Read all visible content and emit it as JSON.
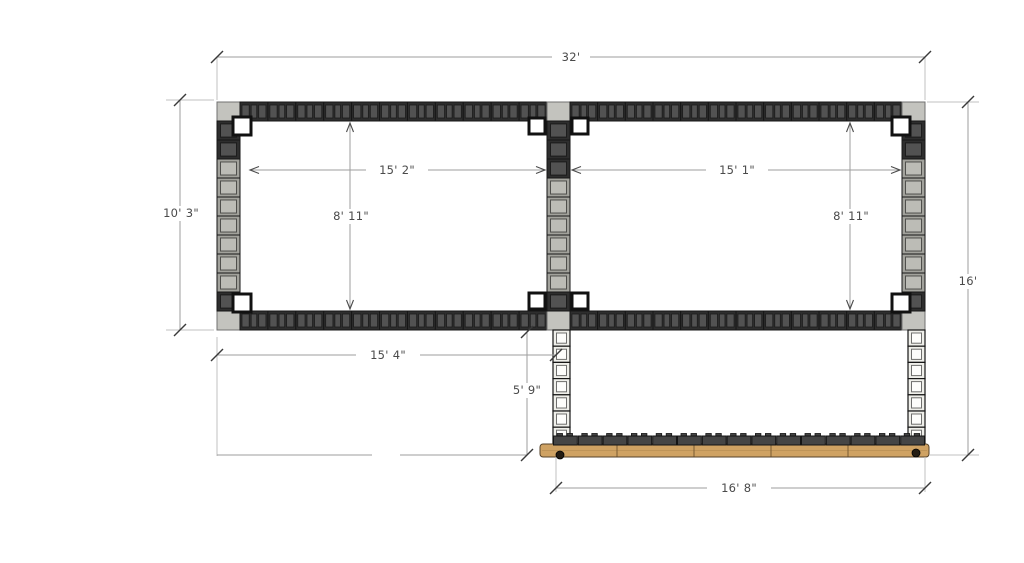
{
  "dims": {
    "overall_width": "32'",
    "left_height": "10' 3\"",
    "right_height": "16'",
    "room_left_width": "15' 2\"",
    "room_right_width": "15' 1\"",
    "room_left_interior_height": "8' 11\"",
    "room_right_interior_height": "8' 11\"",
    "lower_left_width": "15' 4\"",
    "lower_column_height": "5' 9\"",
    "footing_beam_length": "16' 8\""
  },
  "colors": {
    "background": "#ffffff",
    "dim_line": "#9d9d9d",
    "dim_ext": "#c0c0c0",
    "dim_tick": "#3a3a3a",
    "dim_arrow": "#4a4a4a",
    "dim_text": "#4a4a4a",
    "block_dark": "#2e2e2e",
    "block_dark_core": "#525252",
    "block_light": "#a2a29c",
    "block_light_core": "#bcbcb6",
    "block_white": "#efefea",
    "block_white_core": "#fdfdfb",
    "corner_block": "#c3c3be",
    "junction_block": "#ffffff",
    "wood": "#cfa263",
    "wood_edge": "#55422a",
    "wood_joint": "#7a5c33",
    "cap_block": "#454545",
    "outline": "#161616"
  }
}
